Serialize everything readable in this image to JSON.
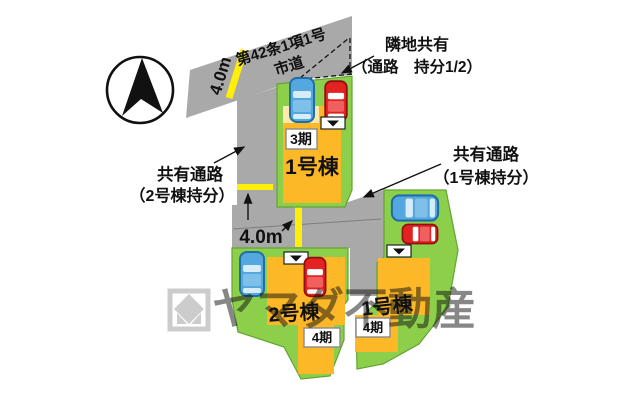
{
  "map": {
    "road": {
      "name_line1": "第42条1項1号",
      "name_line2": "市道",
      "width_label": "4.0m"
    },
    "path": {
      "width_label": "4.0m"
    },
    "annotations": {
      "neighbor_shared_line1": "隣地共有",
      "neighbor_shared_line2": "（通路　持分1/2）",
      "shared_path_b2_line1": "共有通路",
      "shared_path_b2_line2": "（2号棟持分）",
      "shared_path_b1_line1": "共有通路",
      "shared_path_b1_line2": "（1号棟持分）"
    },
    "lots": [
      {
        "name": "1号棟",
        "phase": "3期"
      },
      {
        "name": "2号棟",
        "phase": "4期"
      },
      {
        "name": "1号棟",
        "phase": "4期"
      }
    ],
    "watermark": "ヤマダ不動産",
    "colors": {
      "lot_green": "#8ccf4a",
      "building_yellow": "#fdb827",
      "building_light": "#ffe8ad",
      "road_gray": "#a9a9a9",
      "stripe_yellow": "#ffee0a",
      "car_blue": "#55a8df",
      "car_red": "#e32222"
    }
  }
}
